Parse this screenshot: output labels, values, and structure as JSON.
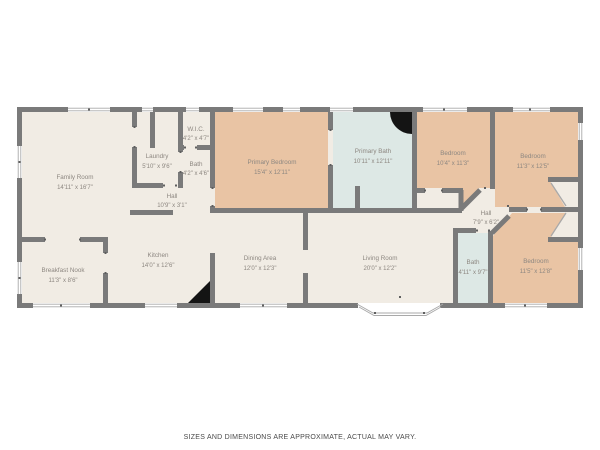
{
  "colors": {
    "floor": "#f1ece4",
    "bedroom": "#e9c4a4",
    "bath": "#dde8e5",
    "wall": "#7a7a7a",
    "window_line": "#a9a9a9",
    "tick": "#5f5f5f",
    "fixture": "#141414",
    "label": "#8d8781",
    "disclaimer": "#4a4a4a"
  },
  "fixtures": [
    "corner-shower-quarter-circle",
    "kitchen-corner-triangle"
  ],
  "rooms": [
    {
      "id": "family-room",
      "name": "Family Room",
      "dims": "14'11\" x 16'7\""
    },
    {
      "id": "breakfast-nook",
      "name": "Breakfast Nook",
      "dims": "11'3\" x 8'6\""
    },
    {
      "id": "kitchen",
      "name": "Kitchen",
      "dims": "14'0\" x 12'6\""
    },
    {
      "id": "laundry",
      "name": "Laundry",
      "dims": "5'10\" x 9'6\""
    },
    {
      "id": "wic",
      "name": "W.I.C.",
      "dims": "4'2\" x 4'7\""
    },
    {
      "id": "bath-hall",
      "name": "Bath",
      "dims": "4'2\" x 4'6\""
    },
    {
      "id": "hall",
      "name": "Hall",
      "dims": "10'9\" x 3'1\""
    },
    {
      "id": "primary-bedroom",
      "name": "Primary Bedroom",
      "dims": "15'4\" x 12'11\""
    },
    {
      "id": "primary-bath",
      "name": "Primary Bath",
      "dims": "10'11\" x 12'11\""
    },
    {
      "id": "bedroom-front",
      "name": "Bedroom",
      "dims": "10'4\" x 11'3\""
    },
    {
      "id": "bedroom-right",
      "name": "Bedroom",
      "dims": "11'3\" x 12'5\""
    },
    {
      "id": "hall-2",
      "name": "Hall",
      "dims": "7'9\" x 6'2\""
    },
    {
      "id": "dining-area",
      "name": "Dining Area",
      "dims": "12'0\" x 12'3\""
    },
    {
      "id": "living-room",
      "name": "Living Room",
      "dims": "20'0\" x 12'2\""
    },
    {
      "id": "bath-2",
      "name": "Bath",
      "dims": "4'11\" x 9'7\""
    },
    {
      "id": "bedroom-back",
      "name": "Bedroom",
      "dims": "11'5\" x 12'8\""
    }
  ],
  "disclaimer": "SIZES AND DIMENSIONS ARE APPROXIMATE, ACTUAL MAY VARY."
}
